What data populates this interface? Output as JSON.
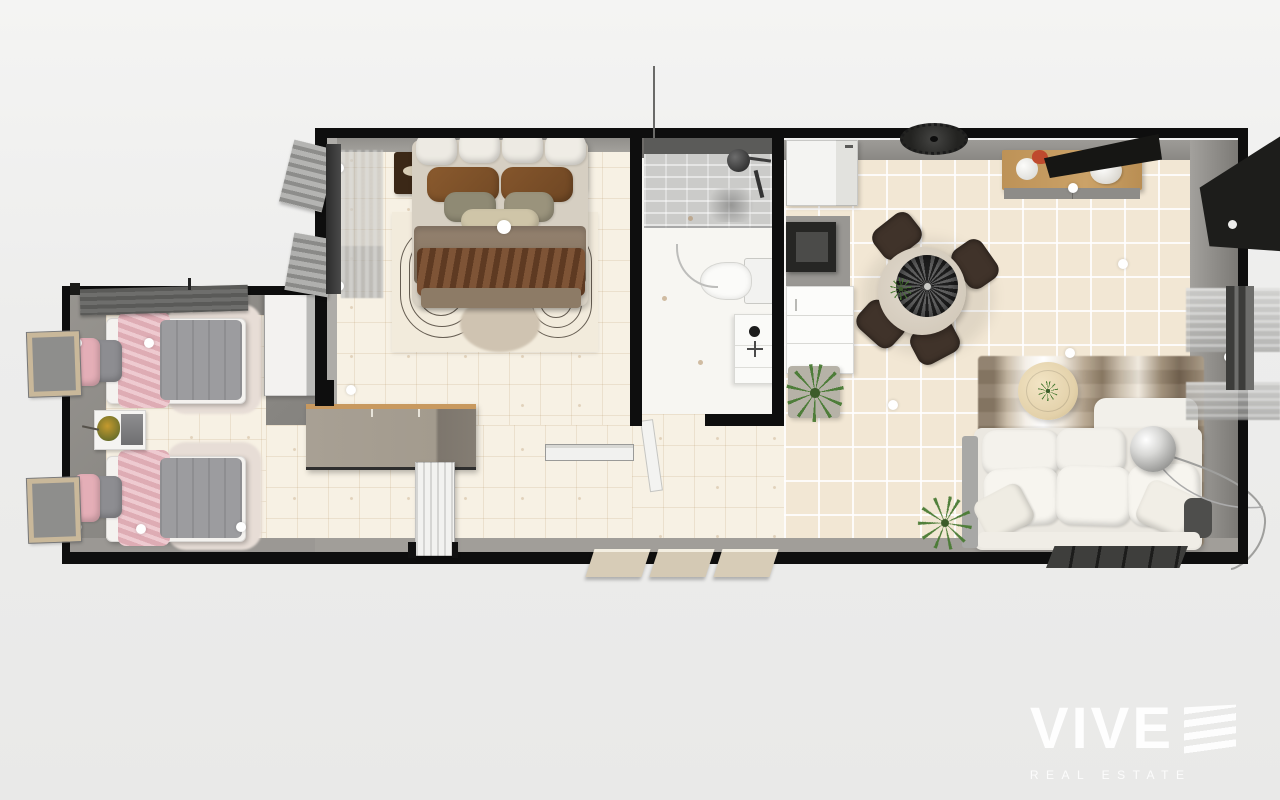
{
  "watermark": {
    "brand": "VIVE",
    "tagline": "REAL ESTATE"
  },
  "scene": {
    "type": "3d-top-down-floorplan-render",
    "rooms": [
      "twin-bedroom",
      "hallway",
      "master-bedroom",
      "bathroom",
      "kitchen",
      "dining-area",
      "living-area"
    ]
  },
  "palette": {
    "background": "#ededec",
    "outer_wall": "#0e0e0e",
    "inner_wall_face": "#8f8d89",
    "cream_floor": "#f7f1e4",
    "beige_tile_floor": "#f2e7d4",
    "master_bed_throw_brown": "#76492a",
    "master_blanket_tan": "#8d7b66",
    "twin_bed_pink": "#e5b1ba",
    "twin_bed_gray": "#9b9b9e",
    "dining_chair_brown": "#40332a",
    "sideboard_wood": "#c59b60",
    "sofa_white": "#f1efe9",
    "plant_green": "#4d7c33",
    "watermark_white": "#ffffff"
  }
}
